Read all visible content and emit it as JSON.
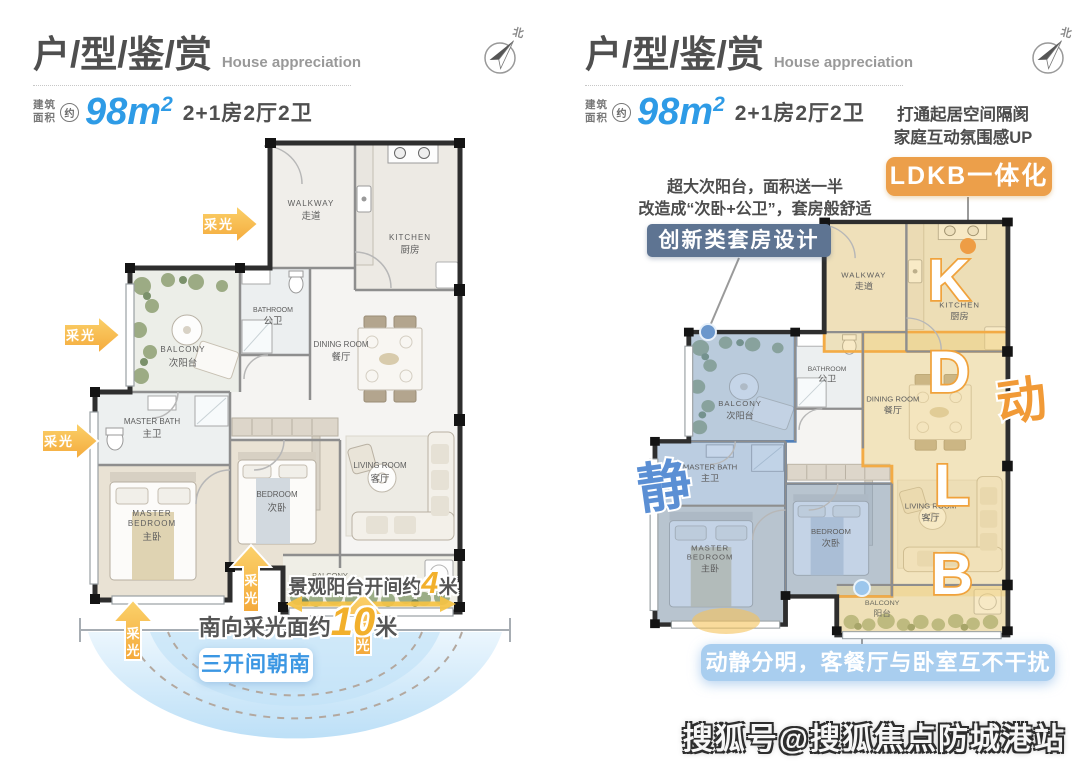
{
  "header": {
    "title": "户/型/鉴/赏",
    "subtitle": "House appreciation",
    "area_label1": "建筑",
    "area_label2": "面积",
    "approx": "约",
    "area_number": "98m",
    "area_sup": "2",
    "spec": "2+1房2厅2卫",
    "compass_north": "北"
  },
  "rooms": {
    "walkway_en": "WALKWAY",
    "walkway_cn": "走道",
    "kitchen_en": "KITCHEN",
    "kitchen_cn": "厨房",
    "bathroom_en": "BATHROOM",
    "bathroom_cn": "公卫",
    "balcony_en": "BALCONY",
    "balcony_cn": "次阳台",
    "dining_en": "DINING ROOM",
    "dining_cn": "餐厅",
    "master_bath_en": "MASTER BATH",
    "master_bath_cn": "主卫",
    "master_en1": "MASTER",
    "master_en2": "BEDROOM",
    "master_cn": "主卧",
    "bedroom_en": "BEDROOM",
    "bedroom_cn": "次卧",
    "living_en": "LIVING ROOM",
    "living_cn": "客厅",
    "south_balcony_en": "BALCONY",
    "south_balcony_cn": "阳台"
  },
  "left_plan": {
    "daylight": "采光",
    "daylight_chars": [
      "采",
      "光"
    ],
    "balcony_width_prefix": "景观阳台开间约",
    "balcony_width_value": "4",
    "balcony_width_unit": "米",
    "south_width_prefix": "南向采光面约",
    "south_width_value": "10",
    "south_width_unit": "米",
    "orientation_badge": "三开间朝南"
  },
  "right_plan": {
    "ldkb_note1": "打通起居空间隔阂",
    "ldkb_note2": "家庭互动氛围感UP",
    "ldkb_badge": "LDKB一体化",
    "suite_note1": "超大次阳台，面积送一半",
    "suite_note2": "改造成“次卧+公卫”，套房般舒适",
    "suite_badge": "创新类套房设计",
    "letters": [
      "K",
      "D",
      "L",
      "B"
    ],
    "zone_active": "动",
    "zone_quiet": "静",
    "bottom_badge": "动静分明，客餐厅与卧室互不干扰"
  },
  "watermark": "搜狐号@搜狐焦点防城港站",
  "colors": {
    "accent_blue": "#2e9be6",
    "daylight_yellow": "#f6b93c",
    "badge_orange": "#ec9f4a",
    "badge_slate": "#5e7492",
    "badge_lightblue": "#a9ceef",
    "zone_blue": "#4f7fba",
    "zone_yellow": "#f3ab45",
    "fan_blue": "#bfe0f6"
  }
}
